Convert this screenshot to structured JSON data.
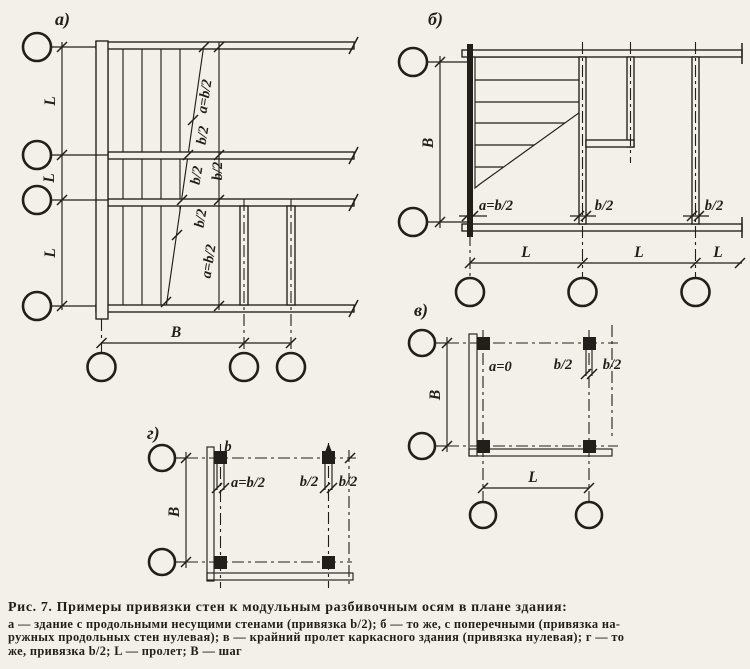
{
  "colors": {
    "paper": "#f2f0e9",
    "ink": "#221f1a"
  },
  "figure": {
    "panels": {
      "a": {
        "tag": "а)"
      },
      "b": {
        "tag": "б)"
      },
      "v": {
        "tag": "в)"
      },
      "g": {
        "tag": "г)"
      }
    },
    "dims": {
      "span": "L",
      "step": "B",
      "wall_width": "b",
      "half": "b/2",
      "a_half": "a=b/2",
      "a_zero": "a=0"
    }
  },
  "caption": {
    "title": "Рис. 7. Примеры привязки стен к модульным разбивочным осям в плане здания:",
    "lines": [
      "а — здание с продольными несущими стенами (привязка b/2); б — то же, с поперечными (привязка на-",
      "ружных продольных стен нулевая); в — крайний пролет каркасного здания (привязка нулевая); г — то",
      "же, привязка b/2;  L — пролет;  В — шаг"
    ]
  }
}
